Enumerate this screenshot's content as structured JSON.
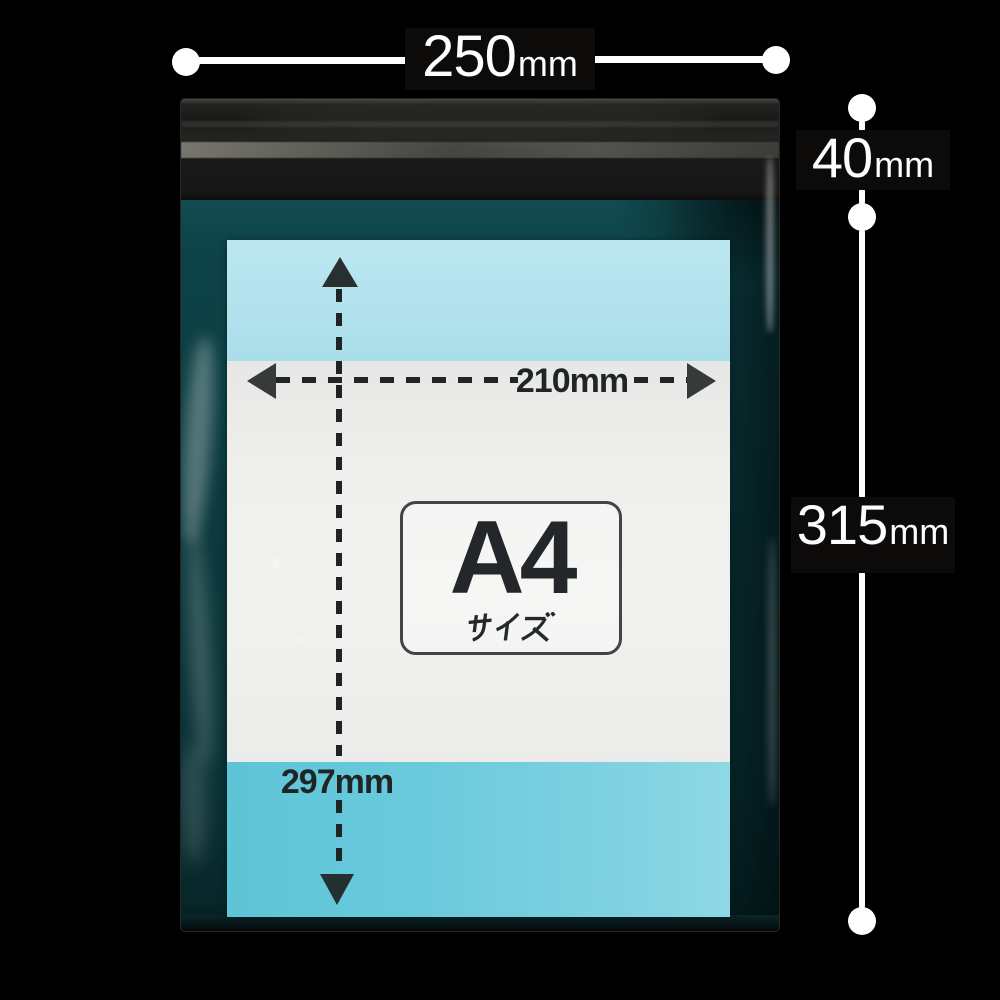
{
  "scene": {
    "description": "Clear OPP plastic bag with adhesive flap shown on black background, containing an A4-size printed insert, annotated with outer and inner dimensions",
    "background_color": "#000000"
  },
  "dimensions": {
    "width": {
      "value": "250",
      "unit": "mm"
    },
    "flap_height": {
      "value": "40",
      "unit": "mm"
    },
    "body_height": {
      "value": "315",
      "unit": "mm"
    }
  },
  "insert_annotations": {
    "paper_width": {
      "value": "210",
      "unit": "mm"
    },
    "paper_height": {
      "value": "297",
      "unit": "mm"
    },
    "size_name": "A4",
    "size_suffix": "サイズ"
  },
  "colors": {
    "background": "#000000",
    "annotation_white": "#ffffff",
    "annotation_ink": "#1f2424",
    "bag_teal": "#0b3a3e",
    "flap_gray": "#191918",
    "insert_cyan_top": "#b0e1ec",
    "insert_cyan_bottom": "#6acadc",
    "paper_white": "#efefed"
  }
}
